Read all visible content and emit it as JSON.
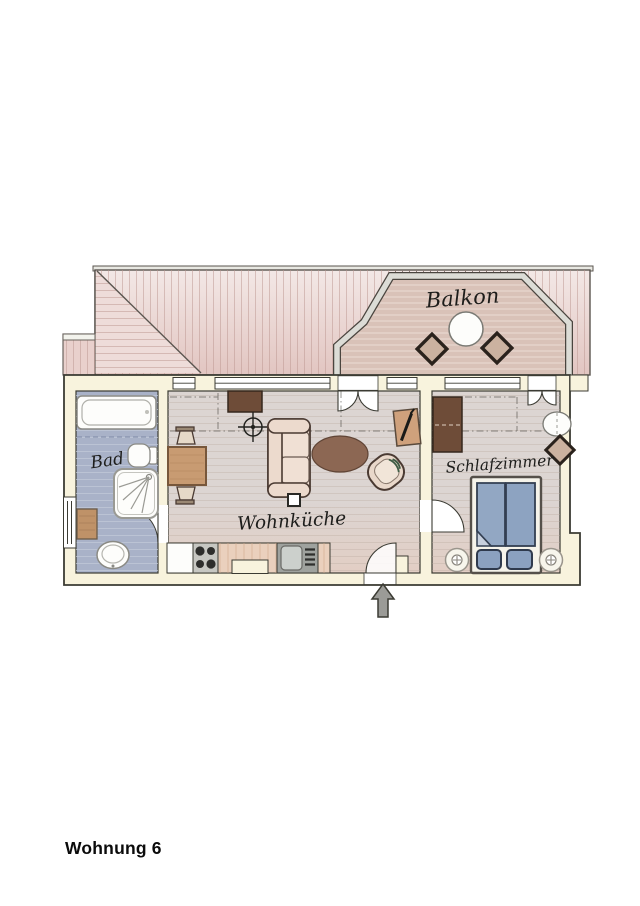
{
  "title": "Wohnung 6",
  "rooms": {
    "balcony": {
      "label": "Balkon"
    },
    "bathroom": {
      "label": "Bad"
    },
    "living_kitchen": {
      "label": "Wohnküche"
    },
    "bedroom": {
      "label": "Schlafzimmer"
    }
  },
  "furniture": {
    "balcony": [
      "round-table",
      "cushion-seat",
      "cushion-seat"
    ],
    "bathroom": [
      "bathtub",
      "toilet",
      "shower",
      "cabinet",
      "washbasin",
      "window"
    ],
    "living_kitchen": [
      "cabinet",
      "ceiling-lamp",
      "sofa",
      "coffee-table",
      "armchair",
      "dining-table",
      "stool",
      "stool",
      "mirror-board",
      "fridge",
      "stove",
      "kitchen-counter",
      "kitchen-sink"
    ],
    "bedroom": [
      "wardrobe",
      "side-table",
      "cushion-seat",
      "double-bed",
      "pillow",
      "pillow",
      "nightstand",
      "nightstand"
    ]
  },
  "icons": {
    "entrance": "up-arrow"
  },
  "colors": {
    "roof-base-top": "#f3e8e6",
    "roof-base-bottom": "#e2c5c1",
    "roof-stripe": "#bc958f",
    "roof-outline": "#5a554f",
    "balcony-floor": "#d9c2b8",
    "balcony-stripe": "#ecdcd4",
    "railing-fill": "#dcdcd6",
    "railing-line": "#4a453f",
    "wall-fill": "#f8f3dd",
    "wall-line": "#3b3b33",
    "bath-floor": "#a9b2c8",
    "bath-stripe": "#c3cad9",
    "wood-floor-top": "#dcd5d2",
    "wood-floor-bottom": "#e2cec4",
    "wood-stripe": "#b9a89e",
    "dark-brown": "#6e4c38",
    "mid-brown": "#c89b72",
    "oval-brown": "#8c6753",
    "tan-cushion": "#cbb2a0",
    "bed-blue": "#92a7c3",
    "pillow-blue": "#8ba1c0",
    "fold-blue": "#c7d0de",
    "cream-white": "#fdfdfb",
    "counter-tan": "#ead0bd",
    "steel-gray": "#c7c7c2",
    "sink-gray": "#9fa29e",
    "arrow-gray": "#9b9b97",
    "ink": "#1d1d1b"
  }
}
